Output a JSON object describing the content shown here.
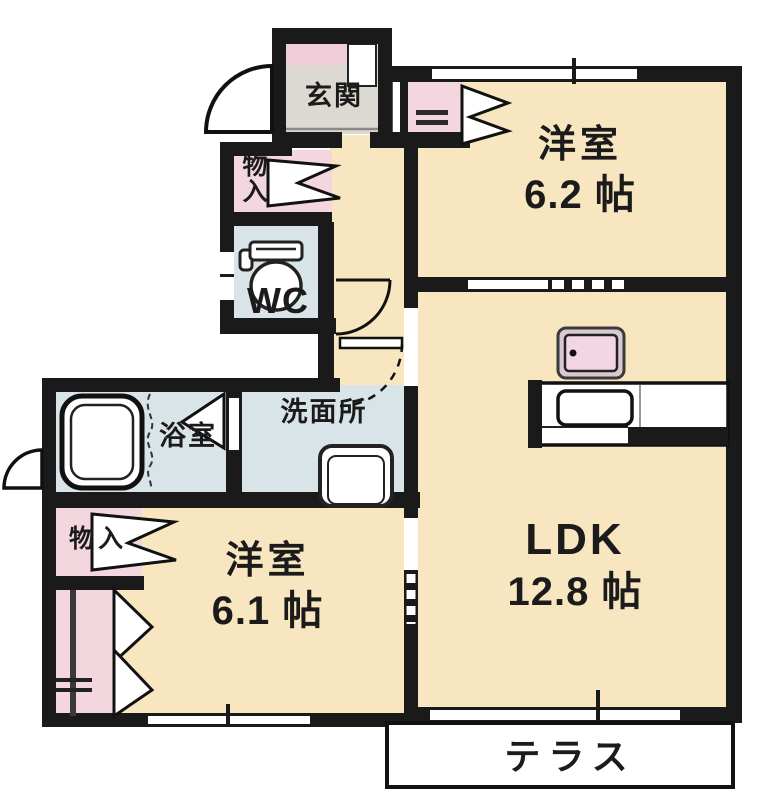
{
  "plan": {
    "rooms": {
      "bedroom_a": {
        "name": "洋室",
        "size": "6.2 帖"
      },
      "ldk": {
        "name": "LDK",
        "size": "12.8 帖"
      },
      "bedroom_b": {
        "name": "洋室",
        "size": "6.1 帖"
      }
    },
    "spaces": {
      "entrance": "玄関",
      "toilet": "WC",
      "bath": "浴室",
      "washroom": "洗面所",
      "terrace": "テラス",
      "storage_upper": "物入",
      "storage_lower": "物入"
    },
    "colors": {
      "wall": "#1a1a1a",
      "room_floor": "#f8e6c0",
      "wet_area_floor": "#d9e4e8",
      "closet_pink": "#f4d7de",
      "entrance_floor": "#dbd9d2",
      "cabinet_pink": "#f0cdd9",
      "stove_pink": "#f2d6e4",
      "background": "#ffffff"
    },
    "icons": [
      "entrance-door-arc",
      "toilet-icon",
      "bathtub-icon",
      "shower-curtain-icon",
      "washing-machine-icon",
      "stove-icon",
      "kitchen-sink-icon",
      "folding-door-icon",
      "window-marks"
    ]
  }
}
